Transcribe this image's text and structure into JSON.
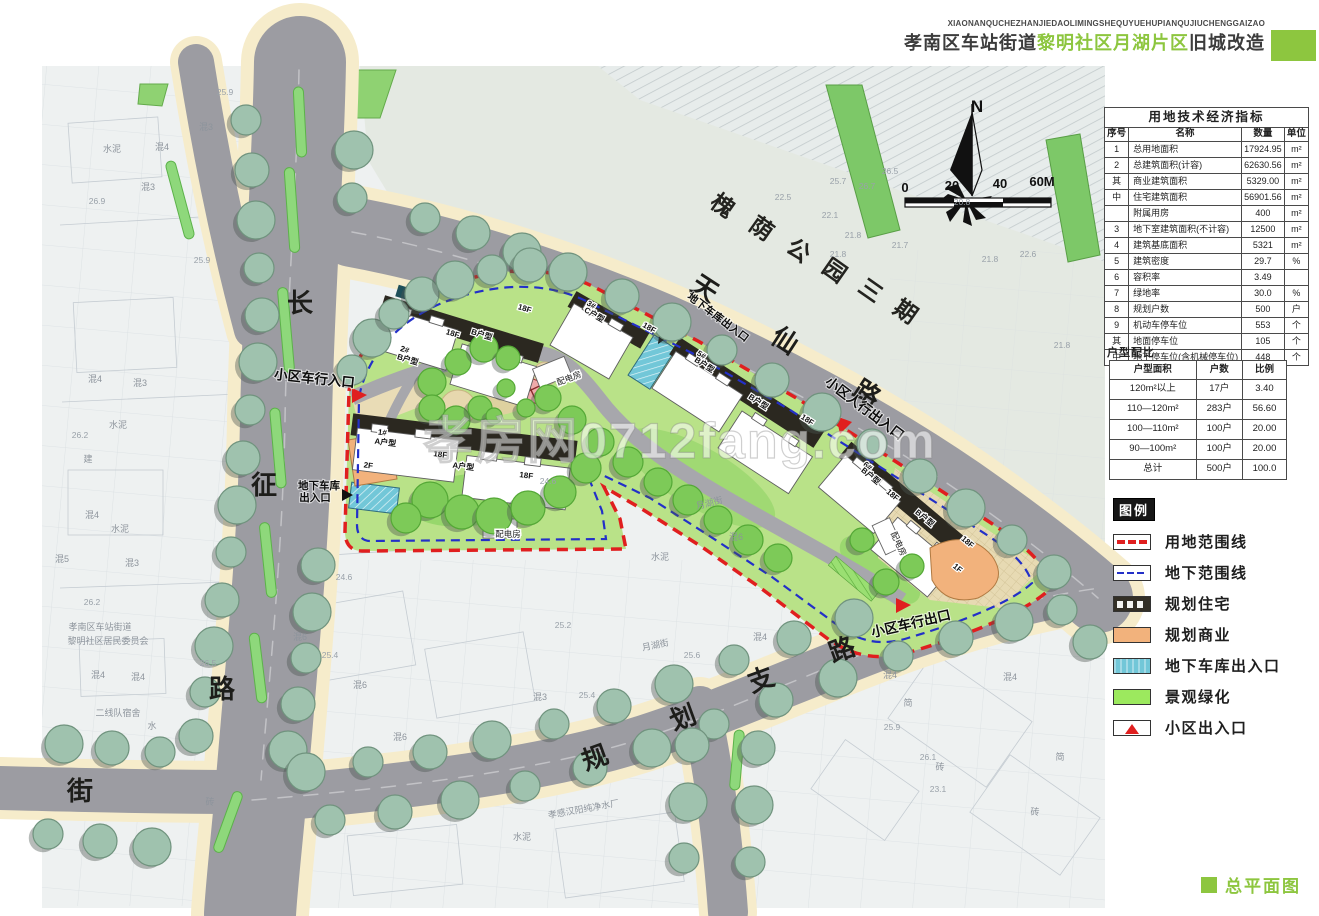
{
  "header": {
    "pinyin": "XIAONANQUCHEZHANJIEDAOLIMINGSHEQUYUEHUPIANQUJIUCHENGGAIZAO",
    "title_prefix": "孝南区车站街道",
    "title_highlight": "黎明社区月湖片区",
    "title_suffix": "旧城改造",
    "accent_color": "#8dc63f"
  },
  "indicators_table": {
    "title": "用地技术经济指标",
    "columns": [
      "序号",
      "名称",
      "数量",
      "单位"
    ],
    "rows": [
      [
        "1",
        "总用地面积",
        "17924.95",
        "m²"
      ],
      [
        "2",
        "总建筑面积(计容)",
        "62630.56",
        "m²"
      ],
      [
        "其",
        "商业建筑面积",
        "5329.00",
        "m²"
      ],
      [
        "中",
        "住宅建筑面积",
        "56901.56",
        "m²"
      ],
      [
        "",
        "附属用房",
        "400",
        "m²"
      ],
      [
        "3",
        "地下室建筑面积(不计容)",
        "12500",
        "m²"
      ],
      [
        "4",
        "建筑基底面积",
        "5321",
        "m²"
      ],
      [
        "5",
        "建筑密度",
        "29.7",
        "%"
      ],
      [
        "6",
        "容积率",
        "3.49",
        ""
      ],
      [
        "7",
        "绿地率",
        "30.0",
        "%"
      ],
      [
        "8",
        "规划户数",
        "500",
        "户"
      ],
      [
        "9",
        "机动车停车位",
        "553",
        "个"
      ],
      [
        "其",
        "地面停车位",
        "105",
        "个"
      ],
      [
        "中",
        "地下停车位(含机械停车位)",
        "448",
        "个"
      ]
    ]
  },
  "unit_mix": {
    "title": "户型配比",
    "columns": [
      "户型面积",
      "户数",
      "比例"
    ],
    "rows": [
      [
        "120m²以上",
        "17户",
        "3.40"
      ],
      [
        "110—120m²",
        "283户",
        "56.60"
      ],
      [
        "100—110m²",
        "100户",
        "20.00"
      ],
      [
        "90—100m²",
        "100户",
        "20.00"
      ],
      [
        "总计",
        "500户",
        "100.0"
      ]
    ]
  },
  "legend": {
    "title": "图例",
    "items": [
      {
        "name": "site-boundary",
        "type": "red-dash",
        "label": "用地范围线",
        "color": "#e01f1f"
      },
      {
        "name": "underground-boundary",
        "type": "blue-dash",
        "label": "地下范围线",
        "color": "#2330c8"
      },
      {
        "name": "planned-residential",
        "type": "residential",
        "label": "规划住宅"
      },
      {
        "name": "planned-commercial",
        "type": "commercial",
        "label": "规划商业",
        "color": "#f2b27c"
      },
      {
        "name": "garage-entrance",
        "type": "garage",
        "label": "地下车库出入口",
        "color": "#72c7d8"
      },
      {
        "name": "landscape-green",
        "type": "green",
        "label": "景观绿化",
        "color": "#9ce95e"
      },
      {
        "name": "community-entrance",
        "type": "entrance",
        "label": "小区出入口"
      }
    ]
  },
  "footer": {
    "label": "总平面图"
  },
  "map": {
    "watermark": "孝房网0712fang.com",
    "labels": [
      {
        "t": "槐",
        "x": 718,
        "y": 212,
        "r": 35,
        "c": "pk"
      },
      {
        "t": "荫",
        "x": 757,
        "y": 235,
        "r": 35,
        "c": "pk"
      },
      {
        "t": "公",
        "x": 794,
        "y": 257,
        "r": 35,
        "c": "pk"
      },
      {
        "t": "园",
        "x": 830,
        "y": 277,
        "r": 35,
        "c": "pk"
      },
      {
        "t": "三",
        "x": 866,
        "y": 297,
        "r": 35,
        "c": "pk"
      },
      {
        "t": "期",
        "x": 901,
        "y": 318,
        "r": 35,
        "c": "pk"
      },
      {
        "t": "天",
        "x": 700,
        "y": 296,
        "r": 33,
        "c": "rd"
      },
      {
        "t": "仙",
        "x": 780,
        "y": 348,
        "r": 33,
        "c": "rd"
      },
      {
        "t": "路",
        "x": 862,
        "y": 401,
        "r": 33,
        "c": "rd"
      },
      {
        "t": "长",
        "x": 300,
        "y": 312,
        "r": 0,
        "c": "rd"
      },
      {
        "t": "征",
        "x": 264,
        "y": 494,
        "r": 0,
        "c": "rd"
      },
      {
        "t": "路",
        "x": 222,
        "y": 698,
        "r": 0,
        "c": "rd"
      },
      {
        "t": "街",
        "x": 80,
        "y": 800,
        "r": 0,
        "c": "rd"
      },
      {
        "t": "规",
        "x": 598,
        "y": 766,
        "r": -20,
        "c": "rd"
      },
      {
        "t": "划",
        "x": 686,
        "y": 726,
        "r": -20,
        "c": "rd"
      },
      {
        "t": "支",
        "x": 764,
        "y": 688,
        "r": -20,
        "c": "rd"
      },
      {
        "t": "路",
        "x": 845,
        "y": 658,
        "r": -20,
        "c": "rd"
      },
      {
        "t": "小区车行入口",
        "x": 314,
        "y": 383,
        "r": 6,
        "c": "en"
      },
      {
        "t": "小区人行出入口",
        "x": 862,
        "y": 412,
        "r": 37,
        "c": "en"
      },
      {
        "t": "小区车行出口",
        "x": 912,
        "y": 628,
        "r": -13,
        "c": "en"
      },
      {
        "t": "地下车库",
        "x": 319,
        "y": 489,
        "r": 0,
        "c": "en2"
      },
      {
        "t": "出入口",
        "x": 315,
        "y": 501,
        "r": 0,
        "c": "en2"
      },
      {
        "t": "地下车库出入口",
        "x": 716,
        "y": 320,
        "r": 37,
        "c": "en2"
      },
      {
        "t": "配电房",
        "x": 570,
        "y": 381,
        "r": -20,
        "c": "bx"
      },
      {
        "t": "配电房",
        "x": 508,
        "y": 537,
        "r": 0,
        "c": "bx"
      },
      {
        "t": "配电房",
        "x": 896,
        "y": 545,
        "r": 65,
        "c": "bx"
      },
      {
        "t": "1#",
        "x": 382,
        "y": 435,
        "r": 7,
        "c": "bd"
      },
      {
        "t": "A户型",
        "x": 385,
        "y": 445,
        "r": 7,
        "c": "bd"
      },
      {
        "t": "18F",
        "x": 440,
        "y": 457,
        "r": 7,
        "c": "bd"
      },
      {
        "t": "A户型",
        "x": 463,
        "y": 469,
        "r": 7,
        "c": "bd"
      },
      {
        "t": "18F",
        "x": 526,
        "y": 478,
        "r": 7,
        "c": "bd"
      },
      {
        "t": "2F",
        "x": 368,
        "y": 468,
        "r": 7,
        "c": "bd"
      },
      {
        "t": "2#",
        "x": 404,
        "y": 352,
        "r": 17,
        "c": "bd"
      },
      {
        "t": "B户型",
        "x": 407,
        "y": 362,
        "r": 17,
        "c": "bd"
      },
      {
        "t": "18F",
        "x": 452,
        "y": 336,
        "r": 17,
        "c": "bd"
      },
      {
        "t": "B户型",
        "x": 481,
        "y": 337,
        "r": 17,
        "c": "bd"
      },
      {
        "t": "18F",
        "x": 524,
        "y": 311,
        "r": 17,
        "c": "bd"
      },
      {
        "t": "3#",
        "x": 590,
        "y": 307,
        "r": 30,
        "c": "bd"
      },
      {
        "t": "C户型",
        "x": 593,
        "y": 317,
        "r": 30,
        "c": "bd"
      },
      {
        "t": "18F",
        "x": 648,
        "y": 330,
        "r": 30,
        "c": "bd"
      },
      {
        "t": "5#",
        "x": 700,
        "y": 357,
        "r": 33,
        "c": "bd"
      },
      {
        "t": "B户型",
        "x": 703,
        "y": 367,
        "r": 33,
        "c": "bd"
      },
      {
        "t": "B户型",
        "x": 757,
        "y": 404,
        "r": 33,
        "c": "bd"
      },
      {
        "t": "18F",
        "x": 806,
        "y": 422,
        "r": 33,
        "c": "bd"
      },
      {
        "t": "6#",
        "x": 866,
        "y": 468,
        "r": 40,
        "c": "bd"
      },
      {
        "t": "B户型",
        "x": 869,
        "y": 478,
        "r": 40,
        "c": "bd"
      },
      {
        "t": "18F",
        "x": 891,
        "y": 497,
        "r": 40,
        "c": "bd"
      },
      {
        "t": "B户型",
        "x": 923,
        "y": 520,
        "r": 40,
        "c": "bd"
      },
      {
        "t": "18F",
        "x": 966,
        "y": 544,
        "r": 40,
        "c": "bd"
      },
      {
        "t": "1F",
        "x": 956,
        "y": 570,
        "r": 40,
        "c": "bd"
      },
      {
        "t": "水泥",
        "x": 112,
        "y": 152,
        "c": "bg"
      },
      {
        "t": "混4",
        "x": 162,
        "y": 150,
        "c": "bg"
      },
      {
        "t": "混3",
        "x": 206,
        "y": 130,
        "c": "bg"
      },
      {
        "t": "混3",
        "x": 148,
        "y": 190,
        "c": "bg"
      },
      {
        "t": "水泥",
        "x": 118,
        "y": 428,
        "c": "bg"
      },
      {
        "t": "混4",
        "x": 95,
        "y": 382,
        "c": "bg"
      },
      {
        "t": "混3",
        "x": 140,
        "y": 386,
        "c": "bg"
      },
      {
        "t": "建",
        "x": 88,
        "y": 462,
        "c": "bg"
      },
      {
        "t": "混4",
        "x": 92,
        "y": 518,
        "c": "bg"
      },
      {
        "t": "水泥",
        "x": 120,
        "y": 532,
        "c": "bg"
      },
      {
        "t": "混5",
        "x": 62,
        "y": 562,
        "c": "bg"
      },
      {
        "t": "混3",
        "x": 132,
        "y": 566,
        "c": "bg"
      },
      {
        "t": "混4",
        "x": 98,
        "y": 678,
        "c": "bg"
      },
      {
        "t": "混4",
        "x": 138,
        "y": 680,
        "c": "bg"
      },
      {
        "t": "孝南区车站街道",
        "x": 100,
        "y": 630,
        "c": "bg"
      },
      {
        "t": "黎明社区居民委员会",
        "x": 108,
        "y": 644,
        "c": "bg"
      },
      {
        "t": "二线队宿舍",
        "x": 118,
        "y": 716,
        "c": "bg"
      },
      {
        "t": "水",
        "x": 152,
        "y": 729,
        "c": "bg"
      },
      {
        "t": "月湖街",
        "x": 710,
        "y": 506,
        "r": -14,
        "c": "bg"
      },
      {
        "t": "月湖街",
        "x": 656,
        "y": 648,
        "r": -12,
        "c": "bg"
      },
      {
        "t": "水泥",
        "x": 522,
        "y": 840,
        "c": "bg"
      },
      {
        "t": "孝感汉阳纯净水厂",
        "x": 584,
        "y": 812,
        "r": -10,
        "c": "bg"
      },
      {
        "t": "砖",
        "x": 210,
        "y": 805,
        "c": "bg"
      },
      {
        "t": "混6",
        "x": 300,
        "y": 640,
        "c": "bg"
      },
      {
        "t": "混6",
        "x": 360,
        "y": 688,
        "c": "bg"
      },
      {
        "t": "混6",
        "x": 400,
        "y": 740,
        "c": "bg"
      },
      {
        "t": "混3",
        "x": 540,
        "y": 700,
        "c": "bg"
      },
      {
        "t": "水泥",
        "x": 660,
        "y": 560,
        "c": "bg"
      },
      {
        "t": "混6",
        "x": 736,
        "y": 540,
        "c": "bg"
      },
      {
        "t": "混4",
        "x": 760,
        "y": 640,
        "c": "bg"
      },
      {
        "t": "混4",
        "x": 890,
        "y": 678,
        "c": "bg"
      },
      {
        "t": "简",
        "x": 908,
        "y": 706,
        "c": "bg"
      },
      {
        "t": "砖",
        "x": 940,
        "y": 770,
        "c": "bg"
      },
      {
        "t": "混4",
        "x": 1010,
        "y": 680,
        "c": "bg"
      },
      {
        "t": "简",
        "x": 1060,
        "y": 760,
        "c": "bg"
      },
      {
        "t": "砖",
        "x": 1035,
        "y": 815,
        "c": "bg"
      },
      {
        "t": "25.9",
        "x": 225,
        "y": 95,
        "c": "el"
      },
      {
        "t": "26.9",
        "x": 97,
        "y": 204,
        "c": "el"
      },
      {
        "t": "25.9",
        "x": 202,
        "y": 263,
        "c": "el"
      },
      {
        "t": "26.2",
        "x": 80,
        "y": 438,
        "c": "el"
      },
      {
        "t": "26.2",
        "x": 92,
        "y": 605,
        "c": "el"
      },
      {
        "t": "26.5",
        "x": 208,
        "y": 666,
        "c": "el"
      },
      {
        "t": "25.7",
        "x": 838,
        "y": 184,
        "c": "el"
      },
      {
        "t": "26.7",
        "x": 867,
        "y": 189,
        "c": "el"
      },
      {
        "t": "26.5",
        "x": 890,
        "y": 174,
        "c": "el"
      },
      {
        "t": "22.5",
        "x": 783,
        "y": 200,
        "c": "el"
      },
      {
        "t": "22.1",
        "x": 830,
        "y": 218,
        "c": "el"
      },
      {
        "t": "21.8",
        "x": 853,
        "y": 238,
        "c": "el"
      },
      {
        "t": "21.8",
        "x": 838,
        "y": 257,
        "c": "el"
      },
      {
        "t": "21.7",
        "x": 900,
        "y": 248,
        "c": "el"
      },
      {
        "t": "20.8",
        "x": 962,
        "y": 205,
        "c": "el"
      },
      {
        "t": "21.8",
        "x": 990,
        "y": 262,
        "c": "el"
      },
      {
        "t": "22.6",
        "x": 1028,
        "y": 257,
        "c": "el"
      },
      {
        "t": "21.8",
        "x": 1062,
        "y": 348,
        "c": "el"
      },
      {
        "t": "24.6",
        "x": 548,
        "y": 484,
        "c": "el"
      },
      {
        "t": "24.6",
        "x": 344,
        "y": 580,
        "c": "el"
      },
      {
        "t": "25.4",
        "x": 330,
        "y": 658,
        "c": "el"
      },
      {
        "t": "25.2",
        "x": 563,
        "y": 628,
        "c": "el"
      },
      {
        "t": "25.4",
        "x": 587,
        "y": 698,
        "c": "el"
      },
      {
        "t": "25.6",
        "x": 692,
        "y": 658,
        "c": "el"
      },
      {
        "t": "25.9",
        "x": 892,
        "y": 730,
        "c": "el"
      },
      {
        "t": "26.1",
        "x": 928,
        "y": 760,
        "c": "el"
      },
      {
        "t": "23.1",
        "x": 938,
        "y": 792,
        "c": "el"
      },
      {
        "t": "0",
        "x": 905,
        "y": 192,
        "c": "sc"
      },
      {
        "t": "20",
        "x": 952,
        "y": 190,
        "c": "sc"
      },
      {
        "t": "40",
        "x": 1000,
        "y": 188,
        "c": "sc"
      },
      {
        "t": "60M",
        "x": 1042,
        "y": 186,
        "c": "sc"
      },
      {
        "t": "N",
        "x": 977,
        "y": 112,
        "c": "no"
      }
    ]
  }
}
